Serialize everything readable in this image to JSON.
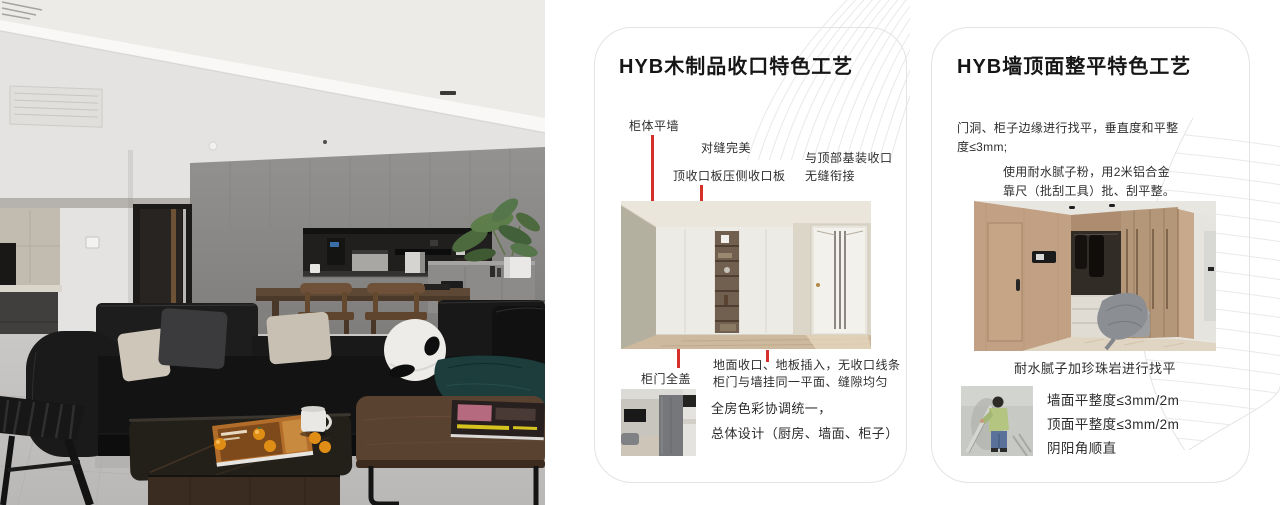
{
  "colors": {
    "accent_red": "#d5302a",
    "card_border": "#e3e3e3",
    "pattern_gray": "#e9e9e9",
    "text_dark": "#161616"
  },
  "cards": [
    {
      "title": "HYB木制品收口特色工艺",
      "labels": {
        "cabinet_flush_wall": "柜体平墙",
        "perfect_seam": "对缝完美",
        "top_closing_panel": "顶收口板压侧收口板",
        "ceiling_joint_1": "与顶部基装收口",
        "ceiling_joint_2": "无缝衔接",
        "full_cover_door": "柜门全盖",
        "floor_joint_1": "地面收口、地板插入，无收口线条",
        "floor_joint_2": "柜门与墙挂同一平面、缝隙均匀"
      },
      "footer_1": "全房色彩协调统一，",
      "footer_2": "总体设计（厨房、墙面、柜子）"
    },
    {
      "title": "HYB墙顶面整平特色工艺",
      "para1_1": "门洞、柜子边缘进行找平，垂直度和平整",
      "para1_2": "度≤3mm;",
      "para2_1": "使用耐水腻子粉，用2米铝合金",
      "para2_2": "靠尺（批刮工具）批、刮平整。",
      "caption": "耐水腻子加珍珠岩进行找平",
      "metrics": [
        "墙面平整度≤3mm/2m",
        "顶面平整度≤3mm/2m",
        "阴阳角顺直"
      ]
    }
  ]
}
